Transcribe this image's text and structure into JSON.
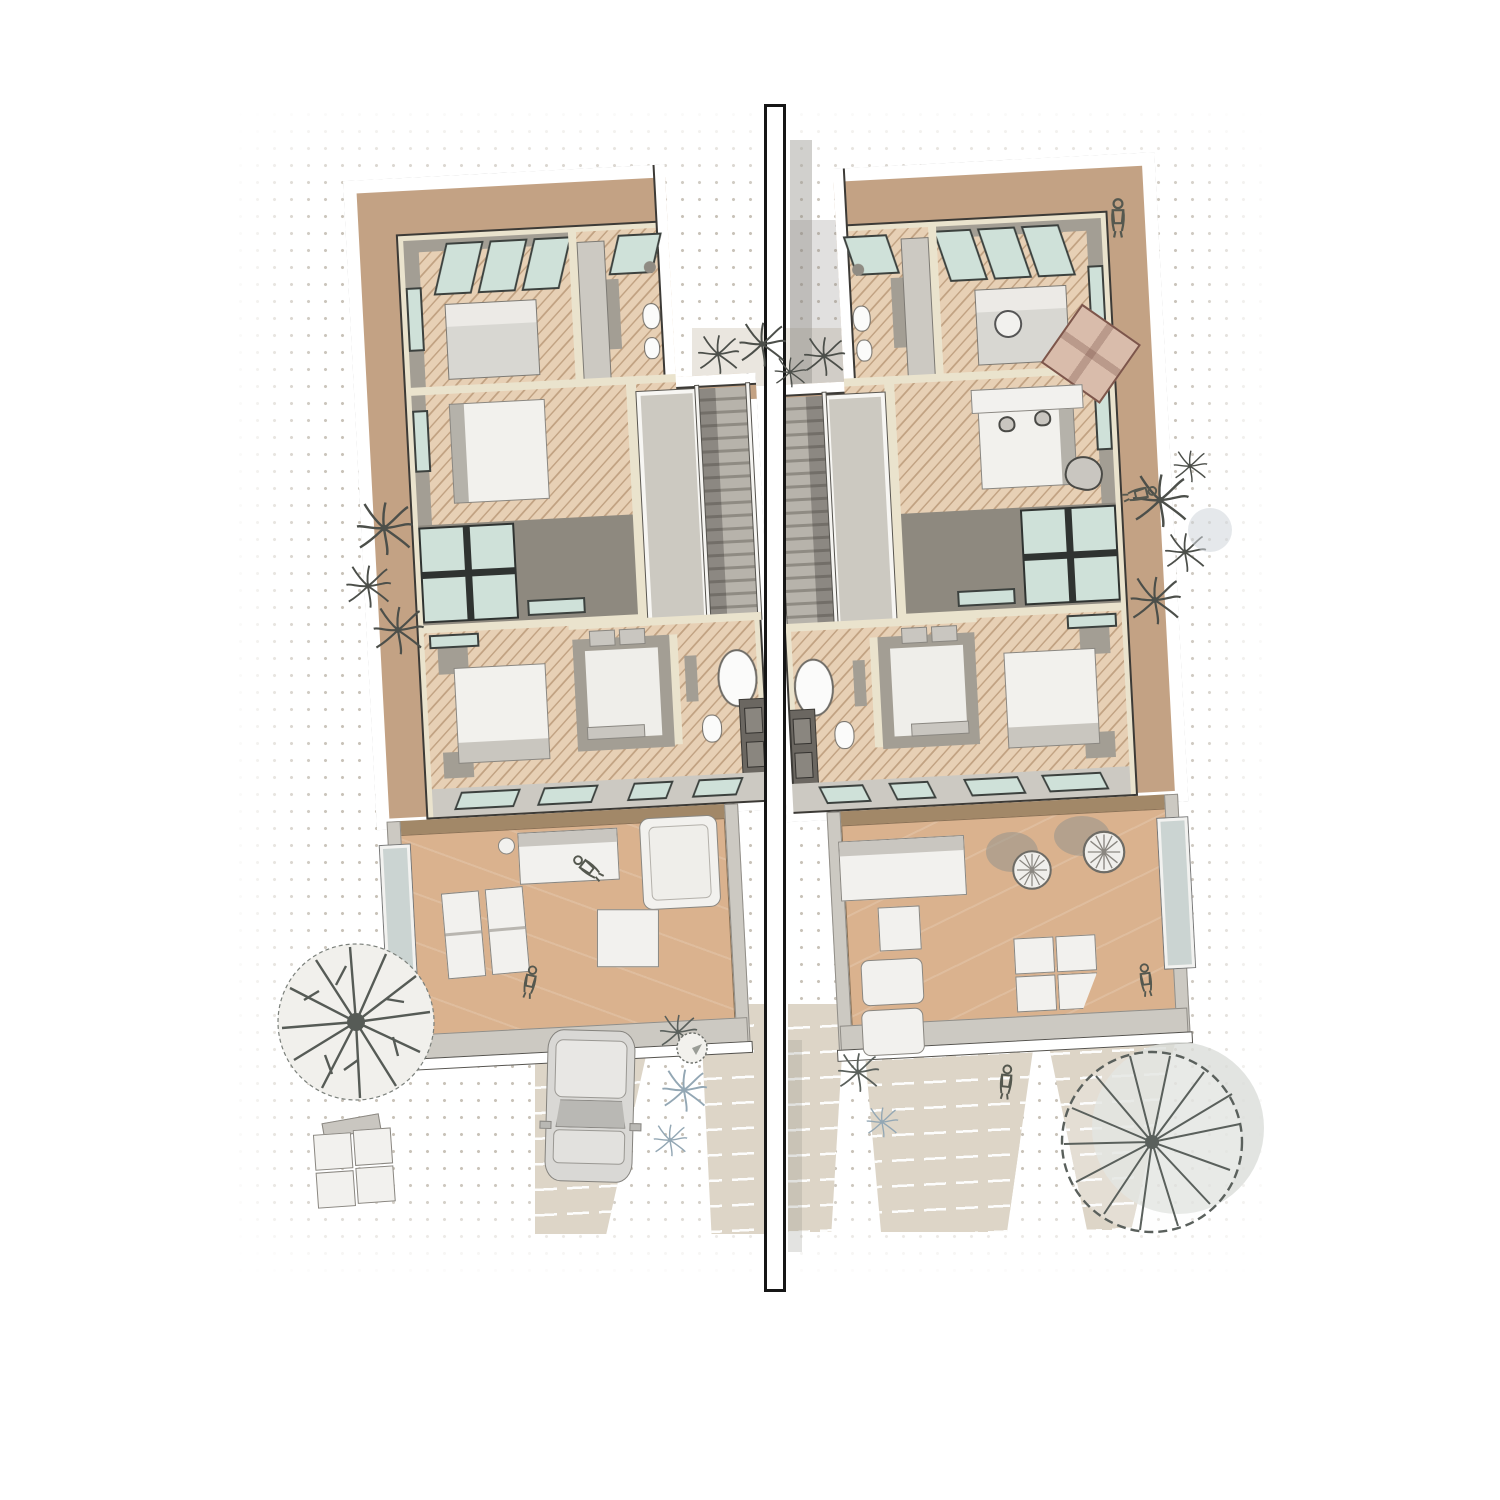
{
  "colors": {
    "paper": "#ffffff",
    "dot": "#c8c2b8",
    "ink": "#2e2c29",
    "cream": "#eae3cd",
    "rooftan": "#c3a284",
    "roofdark": "#a28868",
    "wood": "#e7d0b5",
    "terr": "#dab28e",
    "void": "#8e897f",
    "gwall": "#a39e94",
    "glight": "#ccc9c2",
    "glass": "#cfe1d9",
    "gframe": "#3c413e",
    "drive": "#ddd5c7",
    "pool": "#cbd4d2",
    "furn": "#f2f1ee",
    "fline": "#8a8781",
    "dark": "#6b6761"
  },
  "scene": {
    "type": "architectural-axonometric-floor-plan",
    "site_objects": [
      "halftone-dot-ground",
      "central-party-wall",
      "left-driveway",
      "right-driveway",
      "center-walk-strips",
      "car",
      "round-branch-tree",
      "radial-spoke-tree",
      "palm-plants",
      "shrub",
      "outdoor-lounge-chairs",
      "pedestrians"
    ],
    "left_unit_objects": [
      "parapet-roof",
      "skylit-bedroom",
      "ensuite-bathroom",
      "second-bedroom",
      "double-height-void",
      "picture-window",
      "stair",
      "shaft",
      "master-bedroom",
      "walk-in-closet",
      "freestanding-bathtub",
      "wc",
      "vanity",
      "glass-floor-strips",
      "roof-terrace",
      "outdoor-sofa",
      "daybed",
      "ottoman-table",
      "recliner-pair",
      "plunge-pool",
      "sunbathers"
    ],
    "right_unit_objects": [
      "parapet-roof",
      "ensuite-bathroom",
      "skylit-lounge",
      "round-table",
      "area-rug",
      "armchair",
      "study-bedroom",
      "desk",
      "double-height-void",
      "stair",
      "shaft",
      "master-bedroom",
      "walk-in-closet",
      "freestanding-bathtub",
      "glass-floor-strips",
      "roof-terrace",
      "outdoor-sofa",
      "square-table",
      "sun-loungers",
      "hanging-egg-chairs",
      "outdoor-wardrobe",
      "plunge-pool",
      "seated-person"
    ]
  }
}
